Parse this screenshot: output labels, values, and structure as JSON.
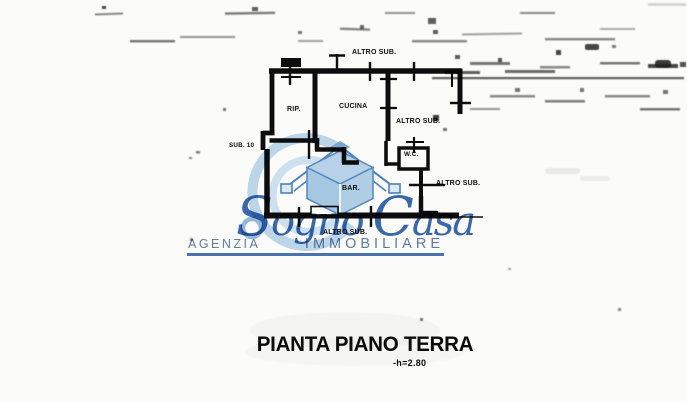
{
  "plan": {
    "rooms": {
      "rip": "RIP.",
      "cucina": "CUCINA",
      "wc": "W.C.",
      "bar": "BAR."
    },
    "labels": {
      "altro_sub": "ALTRO SUB.",
      "sub_10": "SUB. 10"
    }
  },
  "watermark": {
    "brand_word1": "Sogno",
    "brand_word2": "Casa",
    "tagline_word1": "AGENZIA",
    "tagline_word2": "IMMOBILIARE",
    "brand_color": "#2a5ca6",
    "tagline_color": "#5e80a2",
    "house_fill_color": "#a5c7e2"
  },
  "caption": {
    "title": "PIANTA PIANO TERRA",
    "height_note": "-h=2.80"
  },
  "scan": {
    "ink_color": "#0e0e0e",
    "paper_color": "#fbfbfa"
  }
}
